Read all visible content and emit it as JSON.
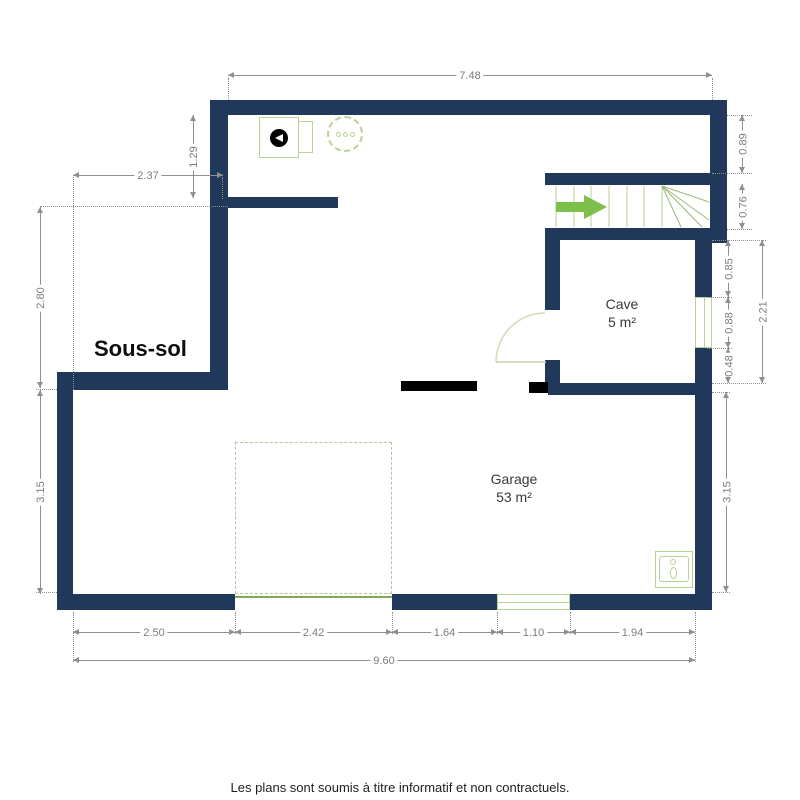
{
  "title": "Sous-sol",
  "rooms": {
    "cave": {
      "name": "Cave",
      "area": "5 m²"
    },
    "garage": {
      "name": "Garage",
      "area": "53 m²"
    }
  },
  "dims": {
    "top_total": "7.48",
    "nook_width": "2.37",
    "stub_offset": "1.29",
    "left_upper": "2.80",
    "left_lower": "3.15",
    "right_top": "0.89",
    "stair_height": "0.76",
    "cave_right_top": "0.85",
    "cave_window": "0.88",
    "cave_right_bottom": "0.48",
    "cave_total": "2.21",
    "right_lower": "3.15",
    "bottom_1": "2.50",
    "bottom_2": "2.42",
    "bottom_3": "1.64",
    "bottom_4": "1.10",
    "bottom_5": "1.94",
    "bottom_total": "9.60"
  },
  "footer": {
    "disclaimer": "Les plans sont soumis à titre informatif et non contractuels."
  },
  "icons": {
    "boiler": "boiler-icon",
    "water_heater": "water-heater-icon",
    "sink": "sink-icon",
    "stairs_arrow": "stairs-direction-arrow-icon"
  },
  "colors": {
    "wall": "#20395b",
    "black_wall": "#000000",
    "arrow": "#7cbf4b",
    "fixture": "#b9d393",
    "door": "#d3dab8",
    "garage_door": "#85a65c",
    "parking": "#b5c49e",
    "dim": "#8f8f8f",
    "dim_text": "#7d7d7d",
    "text": "#3a3a3a"
  }
}
